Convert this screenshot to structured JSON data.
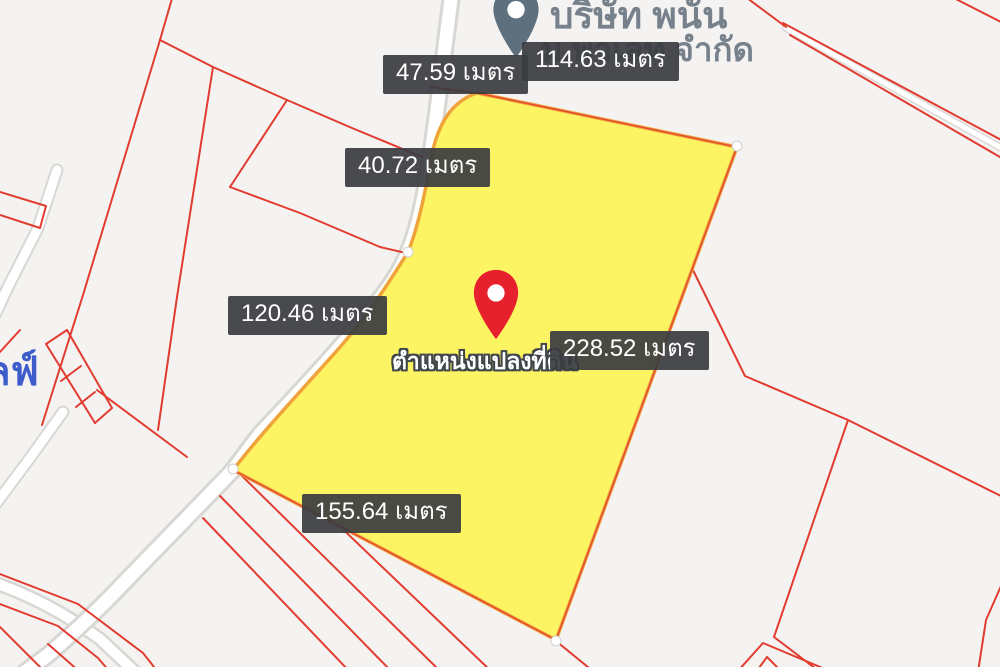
{
  "map": {
    "measurement_labels": [
      {
        "value": "47.59",
        "unit": "เมตร",
        "text": "47.59 เมตร"
      },
      {
        "value": "114.63",
        "unit": "เมตร",
        "text": "114.63 เมตร"
      },
      {
        "value": "40.72",
        "unit": "เมตร",
        "text": "40.72 เมตร"
      },
      {
        "value": "120.46",
        "unit": "เมตร",
        "text": "120.46 เมตร"
      },
      {
        "value": "228.52",
        "unit": "เมตร",
        "text": "228.52 เมตร"
      },
      {
        "value": "155.64",
        "unit": "เมตร",
        "text": "155.64 เมตร"
      }
    ],
    "marker": {
      "label": "ตำแหน่งแปลงที่ดิน"
    },
    "poi": {
      "line1": "บริษัท พนัน",
      "line2": "ม.พาเลท จำกัด"
    },
    "road_label": "ลฟ์",
    "colors": {
      "background": "#f4f3f1",
      "parcel_line": "#e23c31",
      "highlight_fill": "#fcf462",
      "highlight_outline": "#f0a33a",
      "road_fill": "#ffffff",
      "road_casing": "#d9d7d3",
      "label_background": "#3a3d40",
      "label_text": "#ffffff",
      "pin_red": "#e7202e",
      "poi_pin_gray": "#5e707e",
      "poi_text": "#76818c",
      "road_label_blue": "#3f5ccb"
    }
  }
}
